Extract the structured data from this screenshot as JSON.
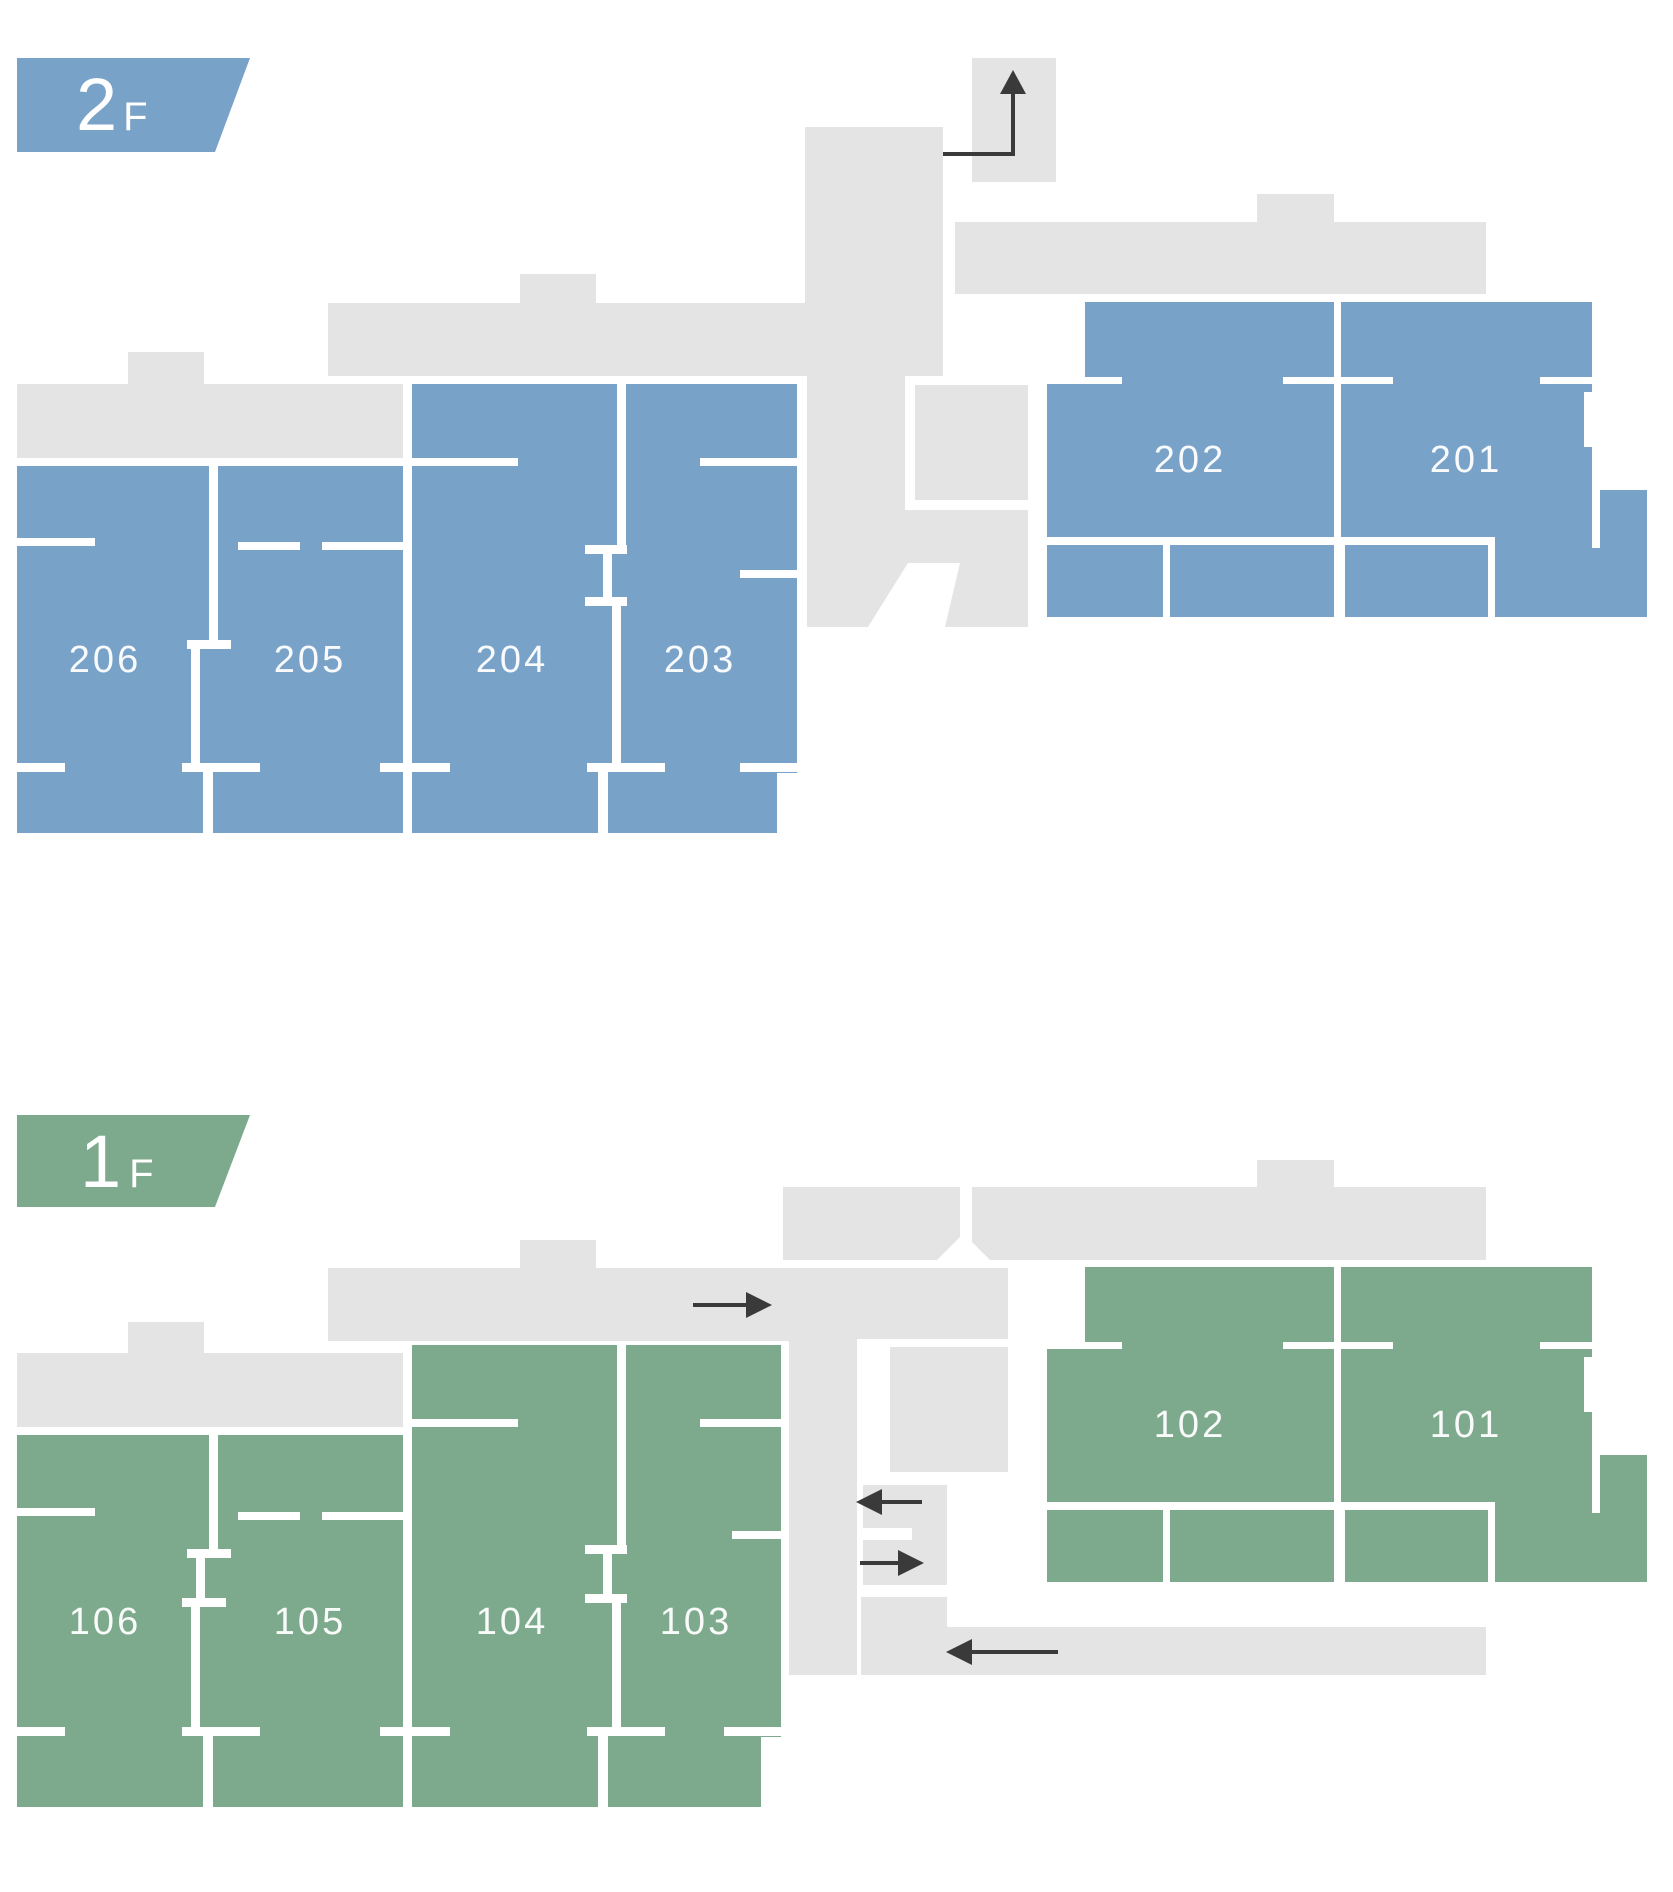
{
  "document": {
    "type": "building-floor-plan",
    "floor_count": 2
  },
  "colors": {
    "floor2_accent": "#78a2c8",
    "floor1_accent": "#7daa8c",
    "corridor_gray": "#e4e4e4",
    "wall_white": "#ffffff",
    "arrow_dark": "#3a3a3a",
    "room_label": "#ffffff"
  },
  "floors": [
    {
      "name": "2F",
      "badge": {
        "level": "2",
        "suffix": "F"
      },
      "accent_color": "#78a2c8",
      "rooms": [
        {
          "number": "206"
        },
        {
          "number": "205"
        },
        {
          "number": "204"
        },
        {
          "number": "203"
        },
        {
          "number": "202"
        },
        {
          "number": "201"
        }
      ],
      "icons": [
        {
          "name": "stairs-up-arrow-icon",
          "glyph": "↑"
        }
      ]
    },
    {
      "name": "1F",
      "badge": {
        "level": "1",
        "suffix": "F"
      },
      "accent_color": "#7daa8c",
      "rooms": [
        {
          "number": "106"
        },
        {
          "number": "105"
        },
        {
          "number": "104"
        },
        {
          "number": "103"
        },
        {
          "number": "102"
        },
        {
          "number": "101"
        }
      ],
      "icons": [
        {
          "name": "corridor-arrow-right-icon",
          "glyph": "→"
        },
        {
          "name": "entry-arrow-left-icon",
          "glyph": "←"
        },
        {
          "name": "entry-arrow-right-icon",
          "glyph": "→"
        },
        {
          "name": "lower-corridor-arrow-left-icon",
          "glyph": "←"
        }
      ]
    }
  ]
}
